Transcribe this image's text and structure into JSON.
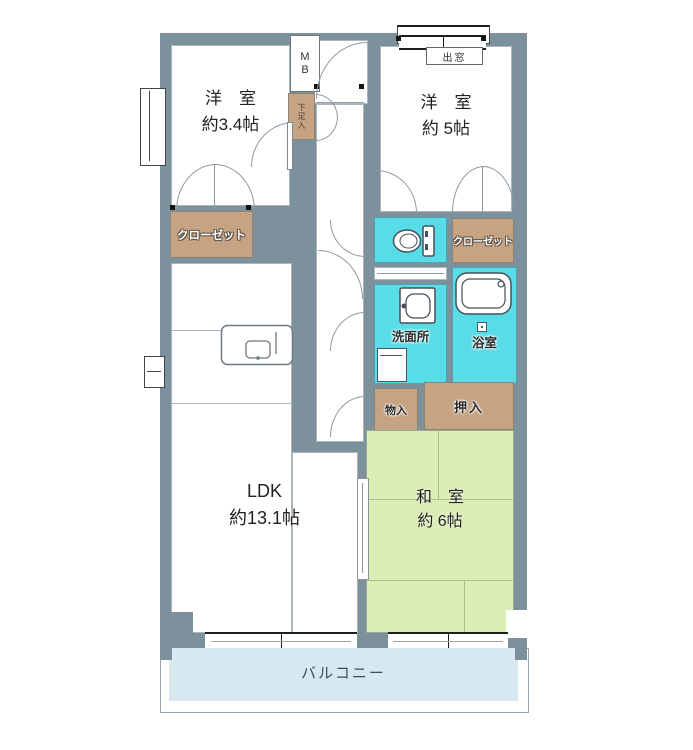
{
  "plan": {
    "rooms": {
      "bedroom_small": {
        "name": "洋　室",
        "size": "約3.4帖"
      },
      "bedroom_medium": {
        "name": "洋　室",
        "size": "約 5帖"
      },
      "ldk": {
        "name": "LDK",
        "size": "約13.1帖"
      },
      "japanese_room": {
        "name": "和　室",
        "size": "約 6帖"
      }
    },
    "storage": {
      "closet_left": "クローゼット",
      "closet_right": "クローゼット",
      "oshiire": "押入",
      "storage_small": "物入",
      "shoe_cabinet": "下足入"
    },
    "wet_areas": {
      "washroom": "洗面所",
      "bathroom": "浴室"
    },
    "exterior": {
      "balcony": "バルコニー",
      "bay_window": "出窓"
    },
    "utility": {
      "meter_box": "MB"
    },
    "icons": {
      "toilet": "toilet-icon",
      "washbasin": "washbasin-icon",
      "bathtub": "bathtub-icon",
      "kitchen_sink": "kitchen-sink-icon",
      "washing_machine": "washing-machine-icon"
    },
    "colors": {
      "wall": "#7d919d",
      "storage": "#c5a383",
      "wet": "#58dce8",
      "tatami": "#daeeb6",
      "balcony": "#d7e8f0"
    }
  }
}
